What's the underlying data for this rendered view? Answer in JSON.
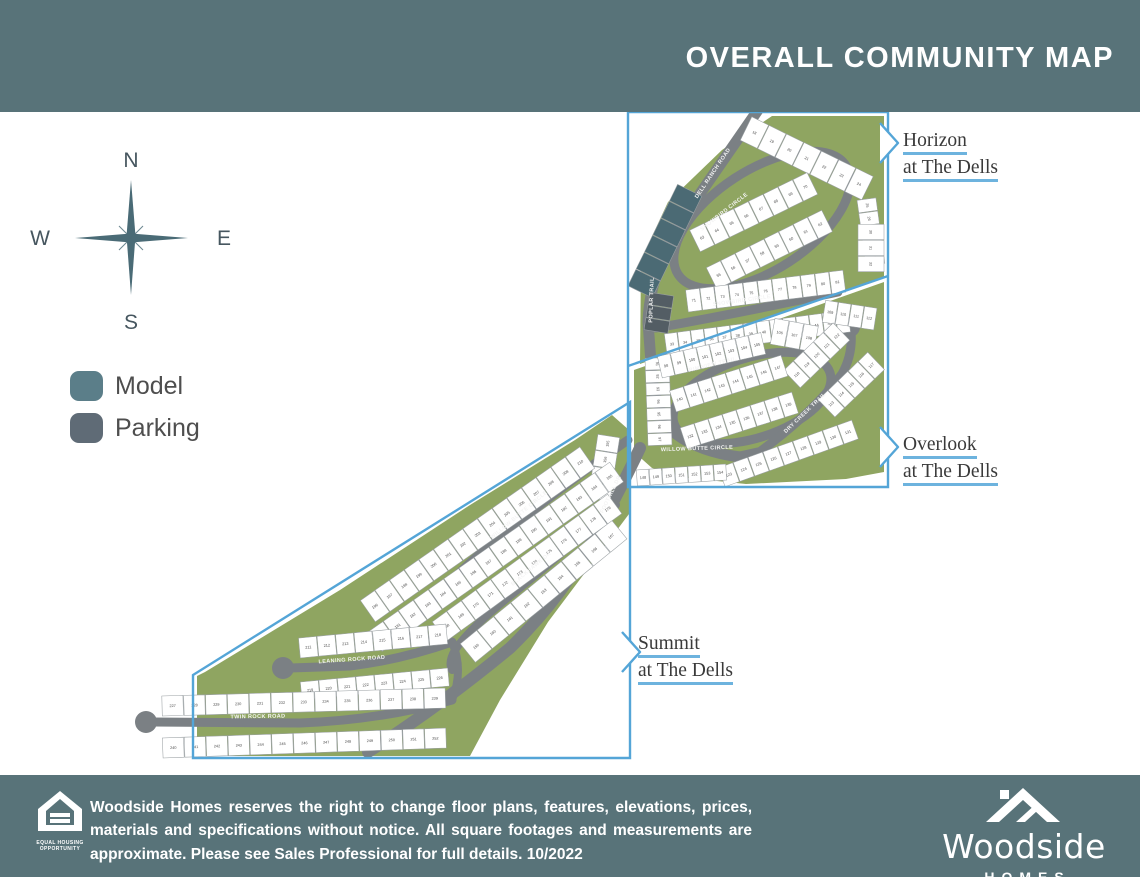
{
  "header": {
    "title": "OVERALL COMMUNITY MAP"
  },
  "compass": {
    "n": "N",
    "e": "E",
    "s": "S",
    "w": "W"
  },
  "legend": {
    "model": "Model",
    "parking": "Parking",
    "model_color": "#5b7e89",
    "parking_color": "#5f6b76"
  },
  "area_labels": [
    {
      "id": "horizon",
      "line1": "Horizon",
      "line2": "at The Dells"
    },
    {
      "id": "overlook",
      "line1": "Overlook",
      "line2": "at The Dells"
    },
    {
      "id": "summit",
      "line1": "Summit",
      "line2": "at The Dells"
    }
  ],
  "footer": {
    "disclaimer_lines": [
      "Woodside Homes reserves the right to change floor plans, features, elevations, prices,",
      "materials and specifications without notice. All square footages and measurements are",
      "approximate. Please see Sales Professional for full details. 10/2022"
    ],
    "eho_line1": "EQUAL HOUSING",
    "eho_line2": "OPPORTUNITY",
    "brand_name": "Woodside",
    "brand_sub": "HOMES"
  },
  "map": {
    "colors": {
      "band": "#587379",
      "green": "#8fa561",
      "road": "#7b8084",
      "model": "#4b6a74",
      "parking": "#535d64",
      "boundary": "#54a5d7",
      "lot_stroke": "#9aa0a3",
      "lot_number": "#4a4a4a",
      "road_label": "#f4f4f4",
      "underline": "#6db3de"
    },
    "greens": [
      {
        "pts": "772,116 884,116 884,278 758,322 640,364 641,260 668,202 722,150"
      },
      {
        "pts": "884,282 884,472 846,479 746,484 688,478 652,468 634,452 634,370"
      },
      {
        "pts": "612,415 629,430 629,514 548,622 500,700 470,756 205,756 197,738 197,676 205,672 340,590 470,505 575,440"
      }
    ],
    "roads": [
      {
        "d": "M 758,110 L 686,214 Q 650,268 648,322 L 652,376 Q 656,414 676,434 Q 700,452 740,457 L 758,453",
        "w": 11
      },
      {
        "ellipse": [
          762,
          220,
          100,
          50,
          -33
        ],
        "w": 9
      },
      {
        "d": "M 656,328 Q 745,312 838,292",
        "w": 9
      },
      {
        "ellipse": [
          752,
          398,
          82,
          40,
          -18
        ],
        "w": 9
      },
      {
        "d": "M 758,453 Q 812,414 842,374 Q 853,354 851,332",
        "w": 9,
        "bulbs": [
          [
            850,
            327,
            10
          ]
        ]
      },
      {
        "d": "M 628,440 Q 570,480 515,525 Q 458,570 432,602 Q 415,624 404,636",
        "w": 9,
        "bulbs": [
          [
            402,
            640,
            9
          ]
        ]
      },
      {
        "d": "M 640,448 Q 622,486 606,515 Q 570,590 510,648 Q 440,706 368,752",
        "w": 12
      },
      {
        "d": "M 616,505 Q 560,556 510,596 Q 470,628 455,650 Q 448,662 452,670",
        "w": 8
      },
      {
        "d": "M 556,558 L 572,534",
        "w": 7,
        "bulbs": [
          [
            575,
            529,
            9
          ]
        ]
      },
      {
        "d": "M 404,636 Q 428,640 452,642",
        "w": 8
      },
      {
        "d": "M 452,642 Q 400,660 350,666 L 290,668",
        "w": 9,
        "bulbs": [
          [
            283,
            668,
            11
          ]
        ]
      },
      {
        "d": "M 452,700 Q 380,720 300,723 L 152,722",
        "w": 9,
        "bulbs": [
          [
            146,
            722,
            11
          ]
        ]
      },
      {
        "d": "M 452,642 Q 464,670 452,700",
        "w": 8
      }
    ],
    "road_labels": [
      {
        "t": "DELL RANCH ROAD",
        "x": 714,
        "y": 174,
        "r": -56
      },
      {
        "t": "POPLAR TRAIL",
        "x": 653,
        "y": 300,
        "r": -88
      },
      {
        "t": "SNOWBIRD CIRCLE",
        "x": 725,
        "y": 213,
        "r": -38
      },
      {
        "t": "SNOWBIRD CIRCLE",
        "x": 742,
        "y": 302,
        "r": -8
      },
      {
        "t": "WILLOW BUTTE CIRCLE",
        "x": 697,
        "y": 450,
        "r": -2
      },
      {
        "t": "RIM VIEW TRAIL",
        "x": 713,
        "y": 366,
        "r": -14
      },
      {
        "t": "DRY CREEK TRAIL",
        "x": 806,
        "y": 414,
        "r": -44
      },
      {
        "t": "FOOTHILL DR",
        "x": 612,
        "y": 495,
        "r": -64
      },
      {
        "t": "WILLOW BUTTE CIRCLE",
        "x": 520,
        "y": 516,
        "r": -40
      },
      {
        "t": "BLACKHAWK DR",
        "x": 532,
        "y": 570,
        "r": -40
      },
      {
        "t": "LEANING ROCK ROAD",
        "x": 352,
        "y": 661,
        "r": -4
      },
      {
        "t": "TWIN ROCK ROAD",
        "x": 258,
        "y": 718,
        "r": -1
      }
    ],
    "lot_strips": [
      {
        "seg": [
          740,
          140,
          862,
          200
        ],
        "count": 7,
        "depth": 26,
        "start": 18,
        "side": 1
      },
      {
        "seg": [
          857,
          200,
          866,
          266
        ],
        "count": 5,
        "depth": 19,
        "start": 25,
        "side": 1
      },
      {
        "seg": [
          884,
          224,
          884,
          272
        ],
        "count": 3,
        "depth": 26,
        "start": 30,
        "side": -1
      },
      {
        "seg": [
          700,
          252,
          818,
          194
        ],
        "count": 8,
        "depth": 24,
        "start": 63,
        "side": 1
      },
      {
        "seg": [
          706,
          268,
          822,
          210
        ],
        "count": 8,
        "depth": 24,
        "start": 55,
        "side": -1
      },
      {
        "seg": [
          688,
          312,
          846,
          292
        ],
        "count": 11,
        "depth": 22,
        "start": 71,
        "side": 1
      },
      {
        "seg": [
          664,
          334,
          848,
          310
        ],
        "count": 14,
        "depth": 22,
        "start": 33,
        "side": -1
      },
      {
        "seg": [
          652,
          298,
          702,
          196
        ],
        "count": 6,
        "depth": 27,
        "type": "model",
        "side": 1
      },
      {
        "seg": [
          644,
          330,
          650,
          292
        ],
        "count": 3,
        "depth": 24,
        "type": "parking",
        "side": -1
      },
      {
        "seg": [
          645,
          358,
          648,
          446
        ],
        "count": 7,
        "depth": 24,
        "start": 91,
        "side": 1
      },
      {
        "seg": [
          662,
          378,
          766,
          354
        ],
        "count": 8,
        "depth": 22,
        "start": 98,
        "side": 1
      },
      {
        "seg": [
          770,
          344,
          814,
          352
        ],
        "count": 3,
        "depth": 26,
        "start": 106,
        "side": 1
      },
      {
        "seg": [
          822,
          322,
          874,
          330
        ],
        "count": 4,
        "depth": 22,
        "start": 109,
        "side": 1
      },
      {
        "seg": [
          818,
          400,
          868,
          352
        ],
        "count": 5,
        "depth": 24,
        "start": 113,
        "side": -1
      },
      {
        "seg": [
          800,
          388,
          850,
          340
        ],
        "count": 5,
        "depth": 24,
        "start": 118,
        "side": 1
      },
      {
        "seg": [
          718,
          468,
          852,
          420
        ],
        "count": 9,
        "depth": 20,
        "start": 123,
        "side": -1
      },
      {
        "seg": [
          680,
          428,
          792,
          392
        ],
        "count": 8,
        "depth": 22,
        "start": 132,
        "side": -1
      },
      {
        "seg": [
          676,
          412,
          788,
          376
        ],
        "count": 8,
        "depth": 22,
        "start": 140,
        "side": 1
      },
      {
        "seg": [
          636,
          470,
          726,
          464
        ],
        "count": 7,
        "depth": 16,
        "start": 148,
        "side": -1
      },
      {
        "seg": [
          598,
          434,
          588,
          498
        ],
        "count": 4,
        "depth": 22,
        "start": 155,
        "side": 1
      },
      {
        "seg": [
          460,
          644,
          612,
          520
        ],
        "count": 9,
        "depth": 24,
        "start": 159,
        "side": -1
      },
      {
        "seg": [
          432,
          622,
          608,
          494
        ],
        "count": 12,
        "depth": 24,
        "start": 168,
        "side": -1
      },
      {
        "seg": [
          368,
          632,
          610,
          462
        ],
        "count": 16,
        "depth": 24,
        "start": 180,
        "side": -1
      },
      {
        "seg": [
          375,
          622,
          595,
          468
        ],
        "count": 15,
        "depth": 26,
        "start": 196,
        "side": 1
      },
      {
        "seg": [
          300,
          658,
          448,
          644
        ],
        "count": 8,
        "depth": 20,
        "start": 211,
        "side": 1
      },
      {
        "seg": [
          300,
          682,
          448,
          668
        ],
        "count": 8,
        "depth": 18,
        "start": 219,
        "side": -1
      },
      {
        "seg": [
          162,
          716,
          446,
          708
        ],
        "count": 13,
        "depth": 20,
        "start": 227,
        "side": 1
      },
      {
        "seg": [
          162,
          738,
          446,
          728
        ],
        "count": 13,
        "depth": 20,
        "start": 240,
        "side": -1
      }
    ],
    "boundaries": [
      {
        "d": "M 628,112 L 888,112 L 888,487 L 628,487 Z"
      },
      {
        "d": "M 628,366 L 888,276"
      },
      {
        "d": "M 630,402 L 193,675 L 193,758 L 630,758 Z"
      }
    ],
    "chevrons": [
      {
        "d": "M 880,123 L 898,143 L 880,163"
      },
      {
        "d": "M 880,427 L 898,447 L 880,467"
      },
      {
        "d": "M 622,632 L 640,652 L 622,672"
      }
    ]
  }
}
